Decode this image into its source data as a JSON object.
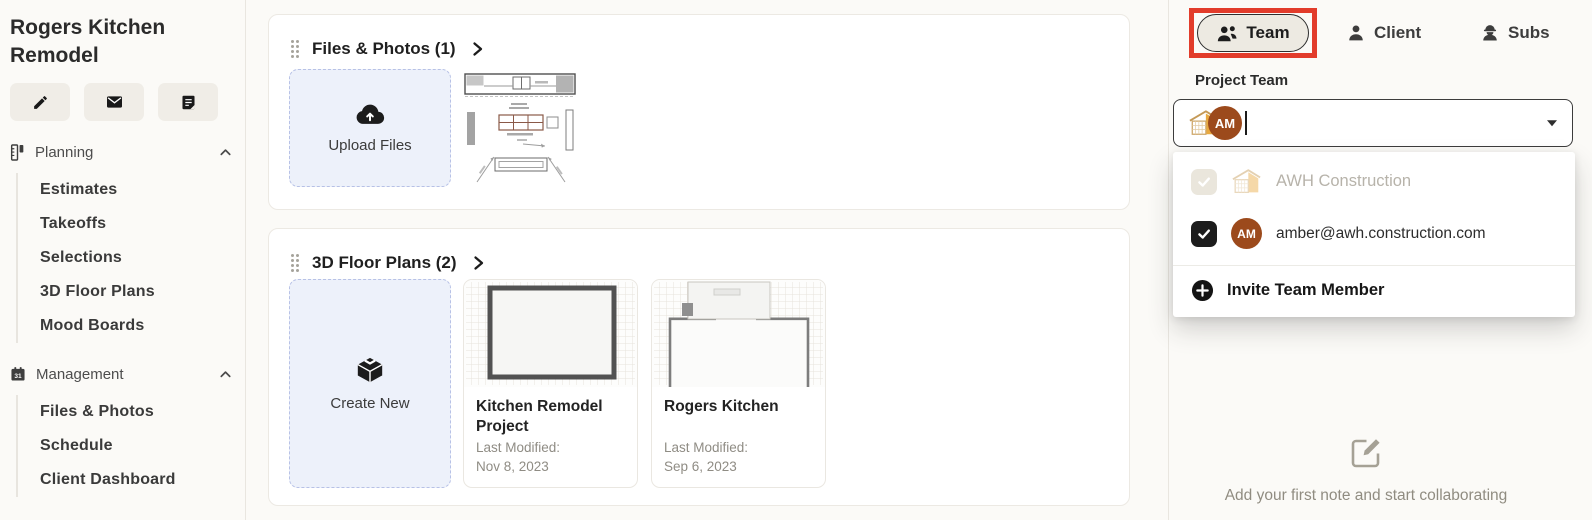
{
  "sidebar": {
    "project_title": "Rogers Kitchen Remodel",
    "actions": [
      {
        "icon": "pencil-icon"
      },
      {
        "icon": "envelope-icon"
      },
      {
        "icon": "notepad-icon"
      }
    ],
    "sections": [
      {
        "icon": "ruler-icon",
        "label": "Planning",
        "items": [
          "Estimates",
          "Takeoffs",
          "Selections",
          "3D Floor Plans",
          "Mood Boards"
        ]
      },
      {
        "icon": "calendar-icon",
        "icon_text": "31",
        "label": "Management",
        "items": [
          "Files & Photos",
          "Schedule",
          "Client Dashboard"
        ]
      }
    ]
  },
  "main": {
    "files_card": {
      "title": "Files & Photos (1)",
      "upload_label": "Upload Files",
      "thumbnail": "kitchen-plan-drawing"
    },
    "plans_card": {
      "title": "3D Floor Plans (2)",
      "create_label": "Create New",
      "plans": [
        {
          "title": "Kitchen Remodel Project",
          "modified_label": "Last Modified:",
          "modified_date": "Nov 8, 2023",
          "thumbnail": "floor-plan-room"
        },
        {
          "title": "Rogers Kitchen",
          "modified_label": "Last Modified:",
          "modified_date": "Sep 6, 2023",
          "thumbnail": "floor-plan-kitchen"
        }
      ]
    }
  },
  "panel": {
    "tabs": [
      {
        "label": "Team",
        "icon": "team-icon",
        "selected": true,
        "highlighted": true
      },
      {
        "label": "Client",
        "icon": "client-icon",
        "selected": false
      },
      {
        "label": "Subs",
        "icon": "subs-icon",
        "selected": false
      }
    ],
    "section_label": "Project Team",
    "member_input": {
      "chips": [
        {
          "icon": "awh-logo"
        },
        {
          "initials": "AM"
        }
      ]
    },
    "dropdown": {
      "options": [
        {
          "label": "AWH Construction",
          "checked": true,
          "disabled": true,
          "icon": "awh-logo"
        },
        {
          "label": "amber@awh.construction.com",
          "checked": true,
          "avatar_initials": "AM"
        }
      ],
      "invite_label": "Invite Team Member"
    },
    "notes_empty_text": "Add your first note and start collaborating"
  },
  "colors": {
    "highlight_red": "#e23c2b",
    "avatar_brown": "#9c4a1c",
    "logo_gold": "#e9a93f",
    "tile_blue_bg": "#edf1fa",
    "selected_tab_bg": "#edeae2"
  }
}
